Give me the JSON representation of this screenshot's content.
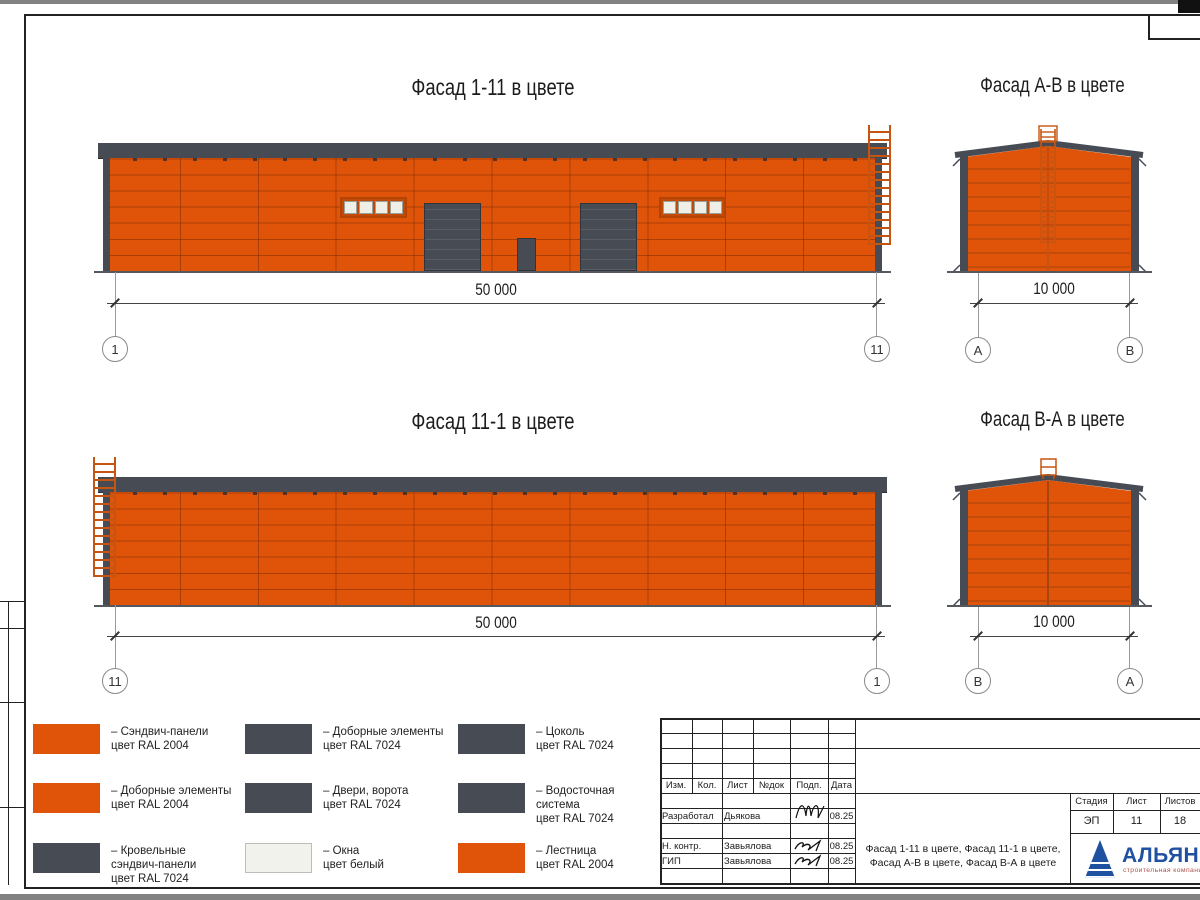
{
  "facades": {
    "f1": {
      "title": "Фасад 1-11 в цвете",
      "dim": "50 000",
      "axis_left": "1",
      "axis_right": "11"
    },
    "fab": {
      "title": "Фасад А-В в цвете",
      "dim": "10 000",
      "axis_left": "А",
      "axis_right": "В"
    },
    "f2": {
      "title": "Фасад 11-1 в цвете",
      "dim": "50 000",
      "axis_left": "11",
      "axis_right": "1"
    },
    "fba": {
      "title": "Фасад В-А в цвете",
      "dim": "10 000",
      "axis_left": "В",
      "axis_right": "А"
    }
  },
  "legend": {
    "items": [
      {
        "color": "#E0540A",
        "lines": [
          "– Сэндвич-панели",
          "цвет RAL 2004",
          ""
        ]
      },
      {
        "color": "#E0540A",
        "lines": [
          "– Доборные элементы",
          "цвет RAL 2004",
          ""
        ]
      },
      {
        "color": "#474B54",
        "lines": [
          "– Кровельные",
          "сэндвич-панели",
          "цвет RAL 7024"
        ]
      },
      {
        "color": "#474B54",
        "lines": [
          "– Доборные элементы",
          "цвет RAL 7024",
          ""
        ]
      },
      {
        "color": "#474B54",
        "lines": [
          "– Двери, ворота",
          "цвет RAL 7024",
          ""
        ]
      },
      {
        "color": "#F2F2EC",
        "lines": [
          "– Окна",
          "цвет белый",
          ""
        ]
      },
      {
        "color": "#474B54",
        "lines": [
          "– Цоколь",
          "цвет RAL 7024",
          ""
        ]
      },
      {
        "color": "#474B54",
        "lines": [
          "– Водосточная",
          "система",
          "цвет RAL 7024"
        ]
      },
      {
        "color": "#E0540A",
        "lines": [
          "– Лестница",
          "цвет RAL 2004",
          ""
        ]
      }
    ]
  },
  "title_block": {
    "rev_headers": {
      "izm": "Изм.",
      "kol": "Кол.",
      "list": "Лист",
      "ndok": "№док",
      "podp": "Подп.",
      "data": "Дата"
    },
    "rows": [
      {
        "role": "Разработал",
        "name": "Дьякова",
        "date": "08.25"
      },
      {
        "role": "Н. контр.",
        "name": "Завьялова",
        "date": "08.25"
      },
      {
        "role": "ГИП",
        "name": "Завьялова",
        "date": "08.25"
      }
    ],
    "stage_header": "Стадия",
    "sheet_header": "Лист",
    "sheets_header": "Листов",
    "stage": "ЭП",
    "sheet_no": "11",
    "sheets_total": "18",
    "doc_title_line1": "Фасад 1-11 в цвете, Фасад 11-1 в цвете,",
    "doc_title_line2": "Фасад А-В в цвете, Фасад В-А в цвете",
    "logo_name": "АЛЬЯНС",
    "logo_sub": "строительная компания"
  },
  "colors": {
    "panel_orange_ral2004": "#E0540A",
    "graphite_ral7024": "#474B54",
    "window_white": "#F2F2EC",
    "ladder_orange": "#C65511",
    "logo_blue": "#2050A0"
  }
}
